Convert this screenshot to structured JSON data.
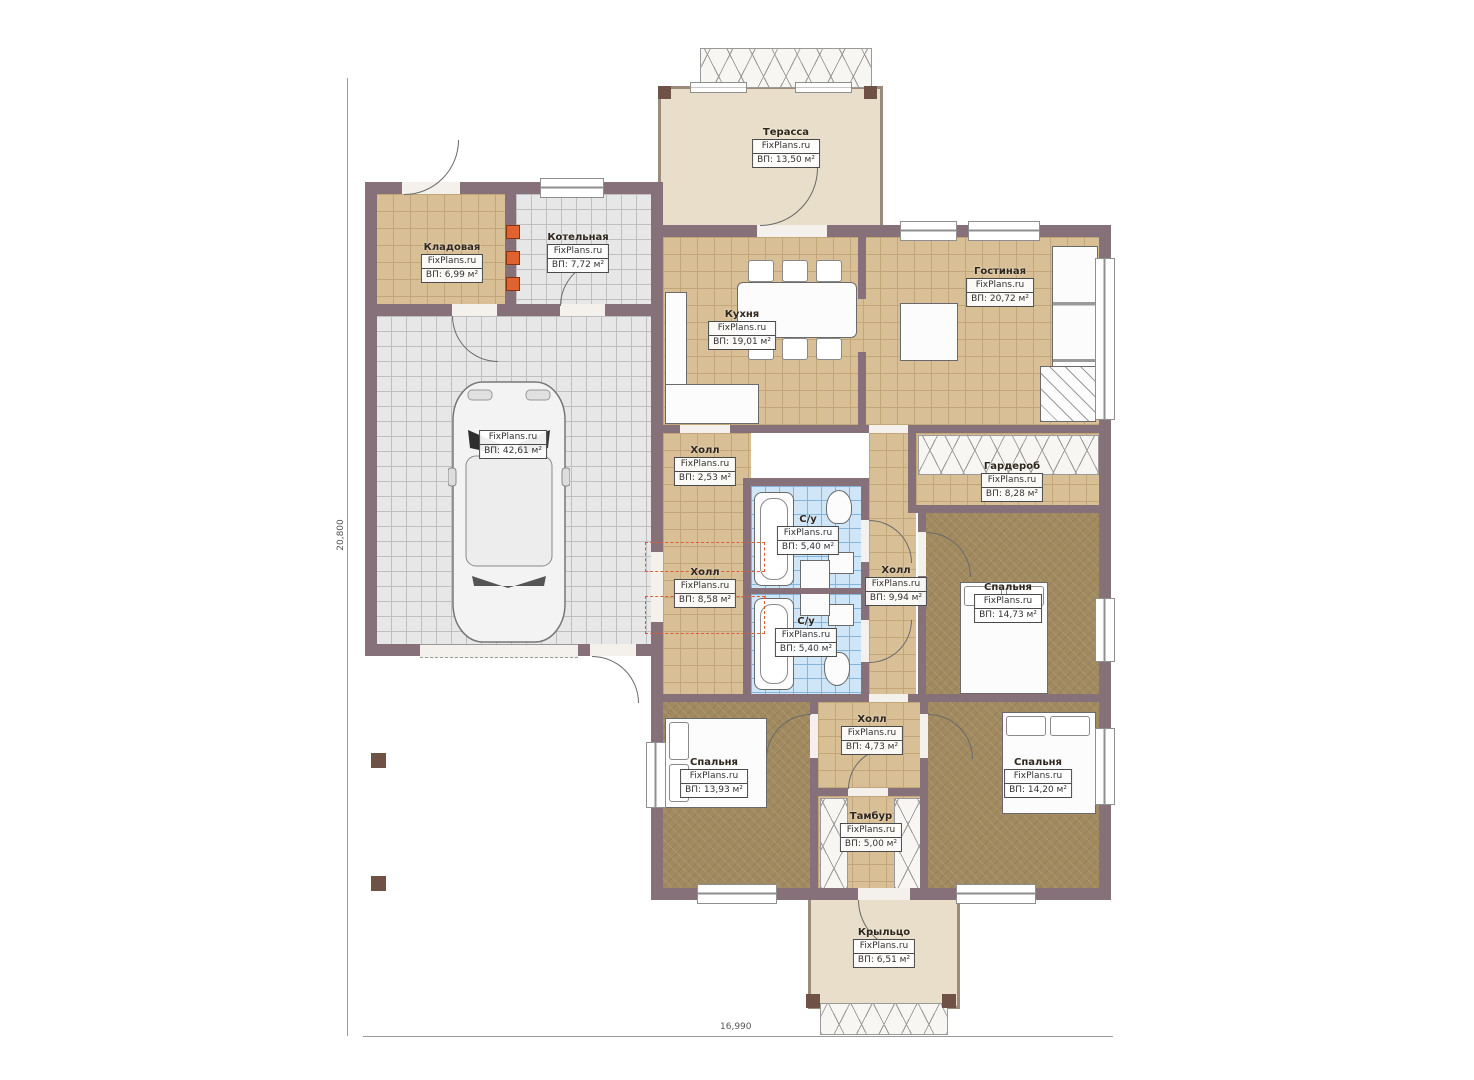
{
  "meta": {
    "brand": "FixPlans.ru"
  },
  "dimensions": {
    "height_label": "20,800",
    "width_label": "16,990"
  },
  "rooms": {
    "terrace": {
      "name": "Терасса",
      "area": "ВП: 13,50 м²"
    },
    "storage": {
      "name": "Кладовая",
      "area": "ВП: 6,99 м²"
    },
    "boiler": {
      "name": "Котельная",
      "area": "ВП: 7,72 м²"
    },
    "garage": {
      "area": "ВП: 42,61 м²"
    },
    "kitchen": {
      "name": "Кухня",
      "area": "ВП: 19,01 м²"
    },
    "living": {
      "name": "Гостиная",
      "area": "ВП: 20,72 м²"
    },
    "hall_small": {
      "name": "Холл",
      "area": "ВП: 2,53 м²"
    },
    "wardrobe": {
      "name": "Гардероб",
      "area": "ВП: 8,28 м²"
    },
    "wc_top": {
      "name": "С/у",
      "area": "ВП: 5,40 м²"
    },
    "hall_mid": {
      "name": "Холл",
      "area": "ВП: 8,58 м²"
    },
    "hall_right": {
      "name": "Холл",
      "area": "ВП: 9,94 м²"
    },
    "bedroom_mid": {
      "name": "Спальня",
      "area": "ВП: 14,73 м²"
    },
    "wc_bottom": {
      "name": "С/у",
      "area": "ВП: 5,40 м²"
    },
    "bedroom_left": {
      "name": "Спальня",
      "area": "ВП: 13,93 м²"
    },
    "hall_bottom": {
      "name": "Холл",
      "area": "ВП: 4,73 м²"
    },
    "tambour": {
      "name": "Тамбур",
      "area": "ВП: 5,00 м²"
    },
    "bedroom_right": {
      "name": "Спальня",
      "area": "ВП: 14,20 м²"
    },
    "porch": {
      "name": "Крыльцо",
      "area": "ВП: 6,51 м²"
    }
  }
}
